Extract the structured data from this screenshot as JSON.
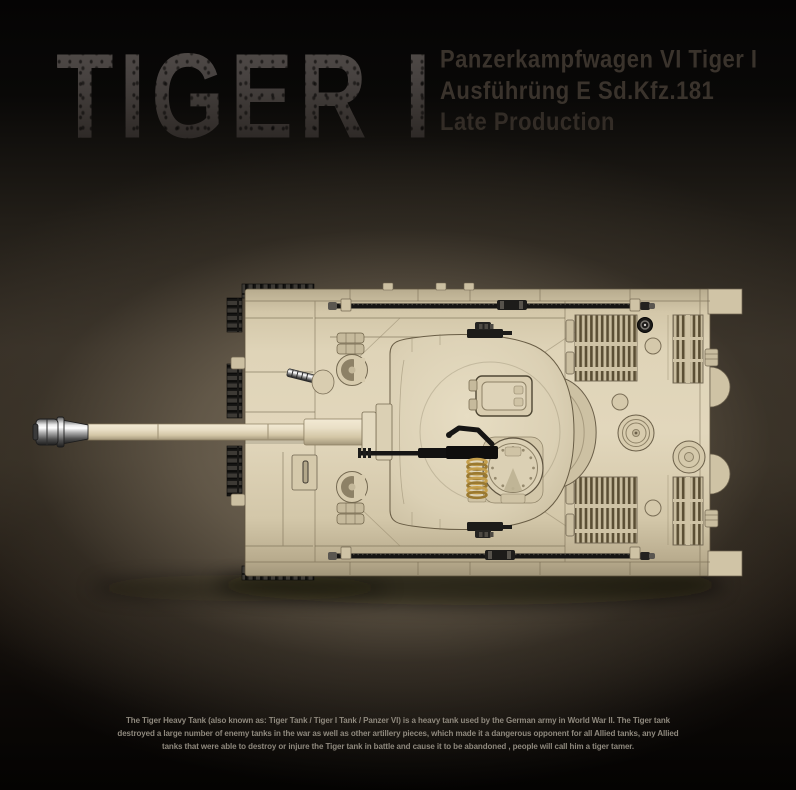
{
  "header": {
    "title": "TIGER I",
    "subtitle_lines": [
      "Panzerkampfwagen VI Tiger I",
      "Ausführüng E Sd.Kfz.181",
      "Late Production"
    ]
  },
  "footer": {
    "description": "The Tiger Heavy Tank (also known as: Tiger Tank / Tiger I Tank / Panzer VI) is a heavy tank used by the German army in World War II. The Tiger tank destroyed a large number of enemy tanks in the war as well as other artillery pieces, which made it a dangerous opponent for all Allied tanks, any Allied tanks that were able to destroy or injure the Tiger tank in battle and cause it to be abandoned , people will call him a tiger tamer."
  },
  "render": {
    "subject": "brick-built Tiger I heavy tank, top view with long gun barrel pointing left",
    "colors": {
      "brick_tan": "#d5c9ab",
      "brick_tan_light": "#e2d7bc",
      "brick_tan_dark": "#b4a88c",
      "track_black": "#1d1c1a",
      "spring_gold": "#bb9540",
      "metal_silver": "#d9d9d9",
      "background_glow": "#7d7260",
      "title_grey": "#46403d",
      "subtitle_grey": "#3a332c",
      "description_grey": "#8e887d"
    }
  }
}
